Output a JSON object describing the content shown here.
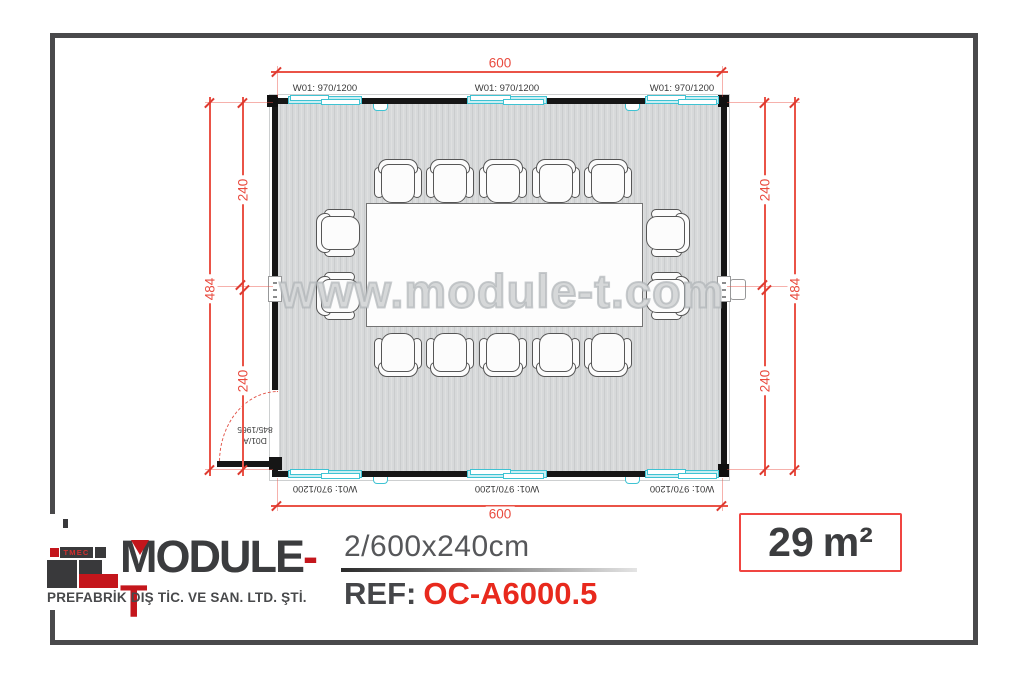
{
  "plan": {
    "watermark": "www.module-t.com",
    "window_label": "W01: 970/1200",
    "door": {
      "code": "D01/A",
      "size": "845/1965"
    },
    "dims": {
      "width_top": "600",
      "width_bottom": "600",
      "left_half_top": "240",
      "left_half_bottom": "240",
      "left_total": "484",
      "right_half_top": "240",
      "right_half_bottom": "240",
      "right_total": "484"
    }
  },
  "footer": {
    "logo_tmec": "TMEC",
    "brand_main": "MODULE",
    "brand_accent": "-T",
    "subtitle": "PREFABRİK DIŞ TİC. VE SAN. LTD. ŞTİ.",
    "size_label": "2/600x240cm",
    "ref_label": "REF:",
    "ref_value": "OC-A6000.5",
    "area_value": "29",
    "area_unit": "m²"
  },
  "colors": {
    "dimension_red": "#ea5347",
    "window_cyan": "#3fc3d3",
    "wall_black": "#161616",
    "brand_dark": "#3b3c3e",
    "brand_red": "#c4161c",
    "ref_red": "#e8291d",
    "frame_gray": "#49494b"
  }
}
